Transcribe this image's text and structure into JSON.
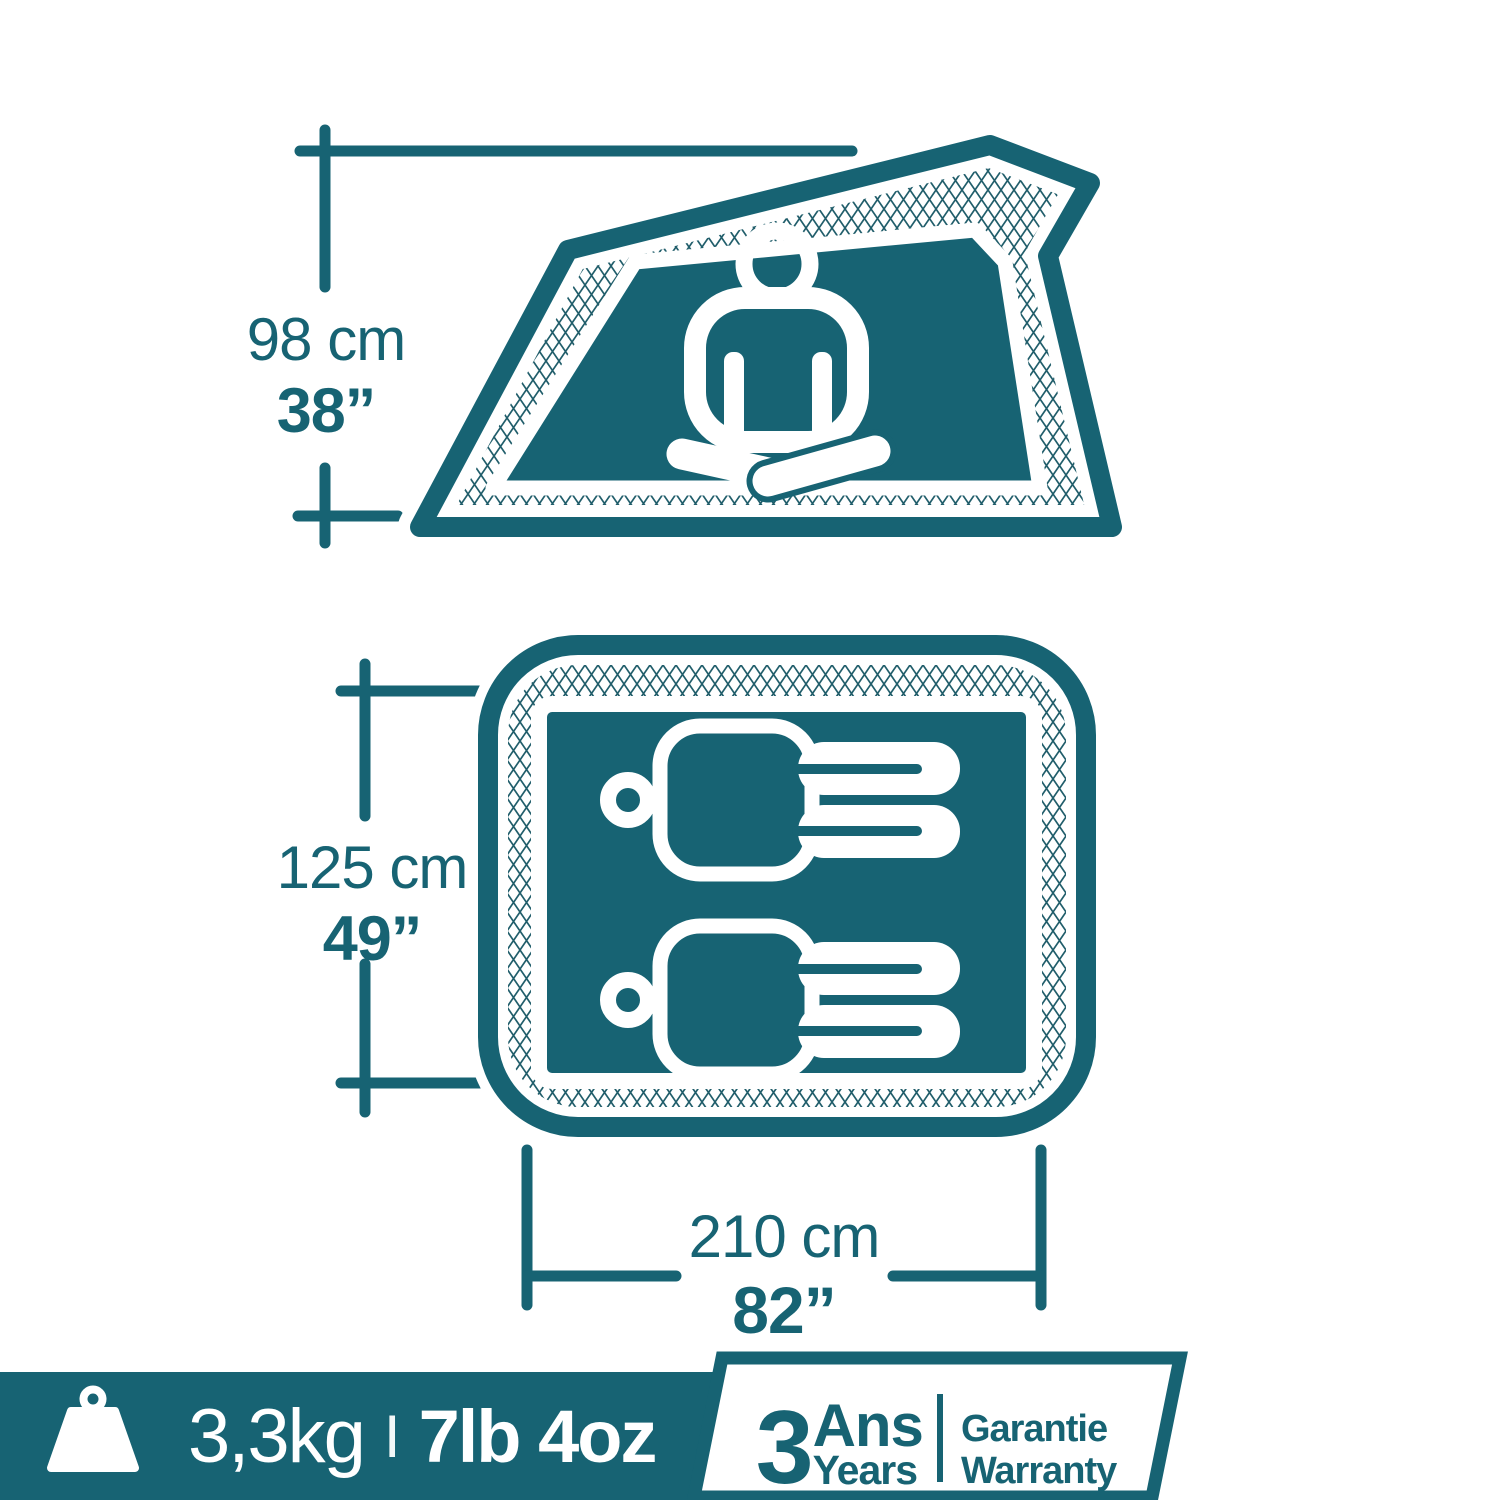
{
  "colors": {
    "teal": "#176373",
    "hatch_line": "#215e6b",
    "white": "#ffffff"
  },
  "icons": {
    "side_view_person": "seated-person-icon",
    "floor_plan_person": "lying-person-icon",
    "footer_weight": "weight-icon"
  },
  "side_view": {
    "height_metric": "98 cm",
    "height_imperial": "38”"
  },
  "floor_plan": {
    "width_metric": "125 cm",
    "width_imperial": "49”",
    "length_metric": "210 cm",
    "length_imperial": "82”"
  },
  "footer": {
    "weight_metric": "3,3kg",
    "weight_separator": "I",
    "weight_imperial": "7lb 4oz",
    "warranty": {
      "years_number": "3",
      "years_fr": "Ans",
      "years_en": "Years",
      "label_fr": "Garantie",
      "label_en": "Warranty"
    }
  }
}
